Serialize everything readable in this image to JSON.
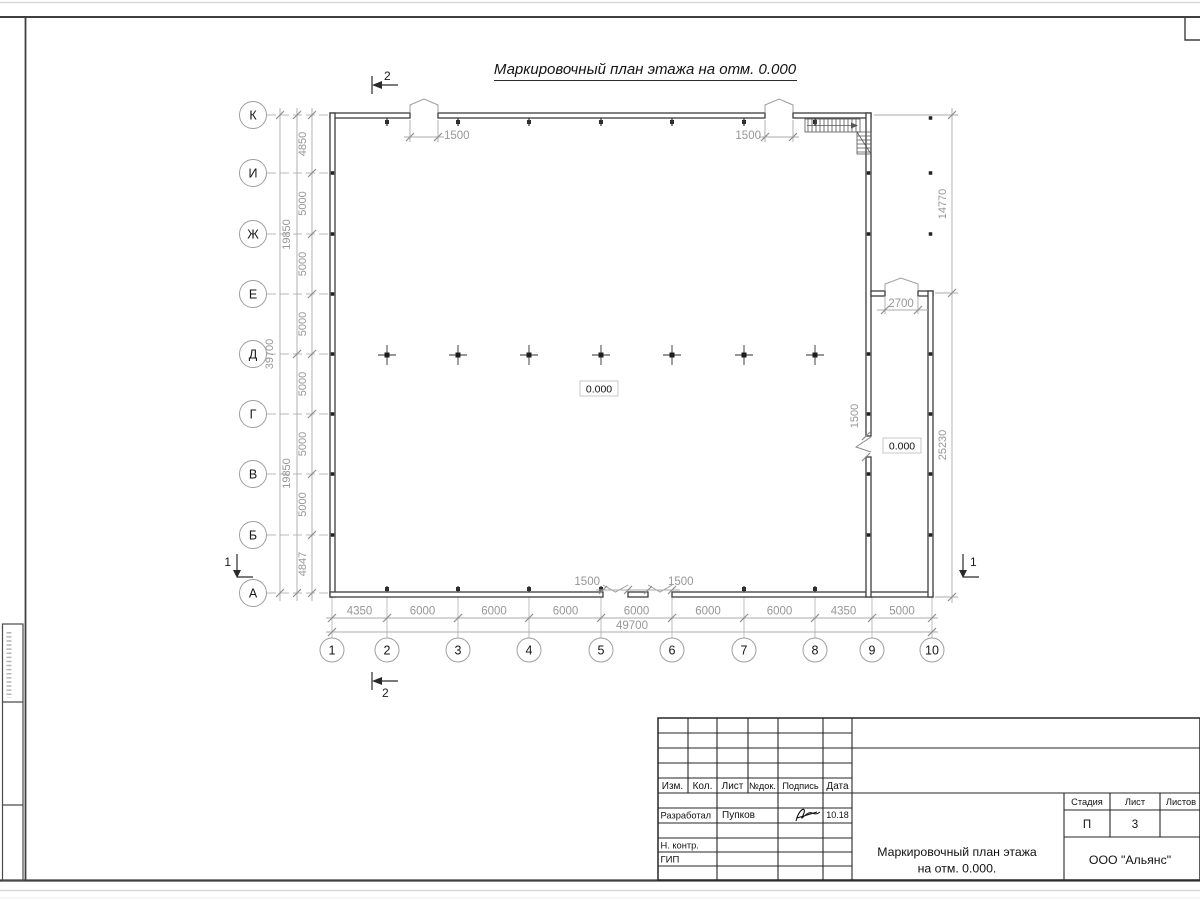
{
  "drawing": {
    "title": "Маркировочный план этажа на отм. 0.000",
    "axes": {
      "rows": [
        "К",
        "И",
        "Ж",
        "Е",
        "Д",
        "Г",
        "В",
        "Б",
        "А"
      ],
      "cols": [
        "1",
        "2",
        "3",
        "4",
        "5",
        "6",
        "7",
        "8",
        "9",
        "10"
      ]
    },
    "dims": {
      "left_values": [
        "4850",
        "5000",
        "5000",
        "5000",
        "5000",
        "5000",
        "5000",
        "4847"
      ],
      "left_mid": [
        "19850",
        "19850"
      ],
      "left_total": "39700",
      "bottom_values": [
        "4350",
        "6000",
        "6000",
        "6000",
        "6000",
        "6000",
        "6000",
        "4350",
        "5000"
      ],
      "bottom_total": "49700",
      "right_top": "14770",
      "right_bottom": "25230"
    },
    "openings": {
      "top_gate_left": "1500",
      "top_gate_right": "1500",
      "bottom_gate_left": "1500",
      "bottom_gate_right": "1500",
      "annex_gate": "2700",
      "annex_door": "1500"
    },
    "levels": {
      "main": "0.000",
      "annex": "0.000"
    },
    "sections": {
      "horizontal": "1",
      "vertical": "2"
    }
  },
  "title_block": {
    "columns": [
      "Изм.",
      "Кол.",
      "Лист",
      "№док.",
      "Подпись",
      "Дата"
    ],
    "developed_label": "Разработал",
    "developed_name": "Пупков",
    "developed_date": "10.18",
    "ncontr_label": "Н. контр.",
    "gip_label": "ГИП",
    "doc_title_1": "Маркировочный план этажа",
    "doc_title_2": "на отм. 0.000.",
    "company": "ООО \"Альянс\"",
    "stage_label": "Стадия",
    "sheet_label": "Лист",
    "sheets_label": "Листов",
    "stage": "П",
    "sheet": "3"
  },
  "colors": {
    "wall": "#3d3d3d",
    "dimension_line": "#ababab",
    "dimension_text": "#979797",
    "frame": "#3f3f3f",
    "paper_edge": "#d9d9d9"
  }
}
